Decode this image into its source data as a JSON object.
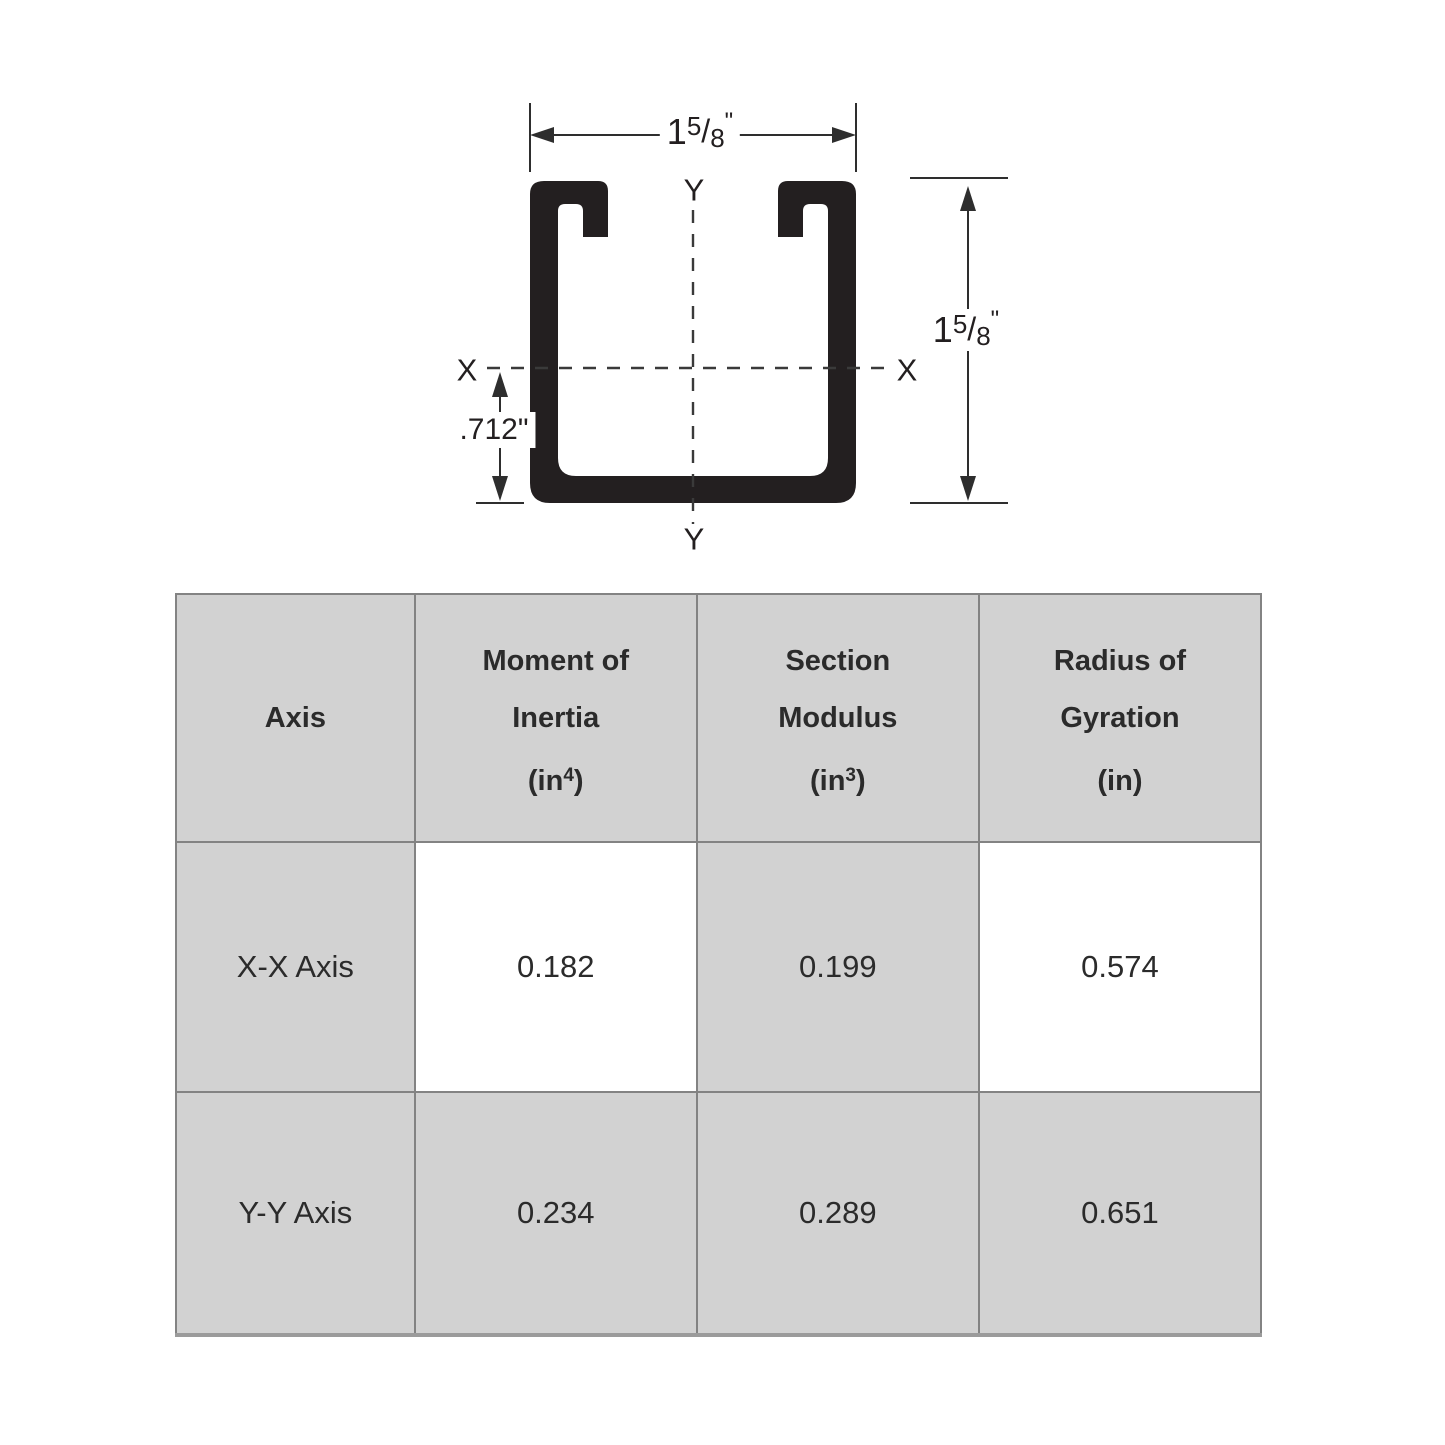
{
  "diagram": {
    "width_dimension": {
      "whole": "1",
      "numerator": "5",
      "fraction_slash": "/",
      "denominator": "8",
      "inch_mark": "\""
    },
    "height_dimension": {
      "whole": "1",
      "numerator": "5",
      "fraction_slash": "/",
      "denominator": "8",
      "inch_mark": "\""
    },
    "centroid_offset_label": ".712\"",
    "x_axis_label_left": "X",
    "x_axis_label_right": "X",
    "y_axis_label_top": "Y",
    "y_axis_label_bottom": "Y"
  },
  "table": {
    "headers": {
      "axis": {
        "line1": "Axis"
      },
      "moment": {
        "line1": "Moment of",
        "line2": "Inertia",
        "unit_open": "(in",
        "unit_sup": "4",
        "unit_close": ")"
      },
      "modulus": {
        "line1": "Section",
        "line2": "Modulus",
        "unit_open": "(in",
        "unit_sup": "3",
        "unit_close": ")"
      },
      "radius": {
        "line1": "Radius of",
        "line2": "Gyration",
        "unit_open": "(in",
        "unit_sup": "",
        "unit_close": ")"
      }
    },
    "rows": [
      {
        "axis": "X-X Axis",
        "moment_of_inertia": "0.182",
        "section_modulus": "0.199",
        "radius_of_gyration": "0.574"
      },
      {
        "axis": "Y-Y Axis",
        "moment_of_inertia": "0.234",
        "section_modulus": "0.289",
        "radius_of_gyration": "0.651"
      }
    ]
  },
  "colors": {
    "cell_gray": "#d2d2d2",
    "grid_line": "#838383",
    "ink": "#231f20"
  }
}
